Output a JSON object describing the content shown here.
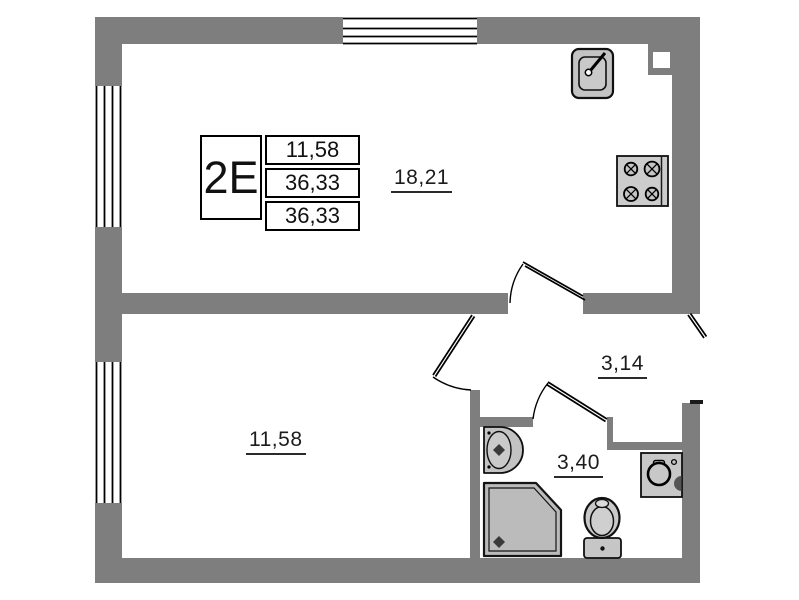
{
  "unit_card": {
    "unit_type": "2E",
    "values": [
      "11,58",
      "36,33",
      "36,33"
    ]
  },
  "room_labels": {
    "kitchen_living": "18,21",
    "bedroom": "11,58",
    "hallway": "3,14",
    "bathroom": "3,40"
  },
  "colors": {
    "wall": "#7e7e7e",
    "outline": "#000000",
    "fixture_fill": "#c6c6c6",
    "background": "#ffffff"
  }
}
